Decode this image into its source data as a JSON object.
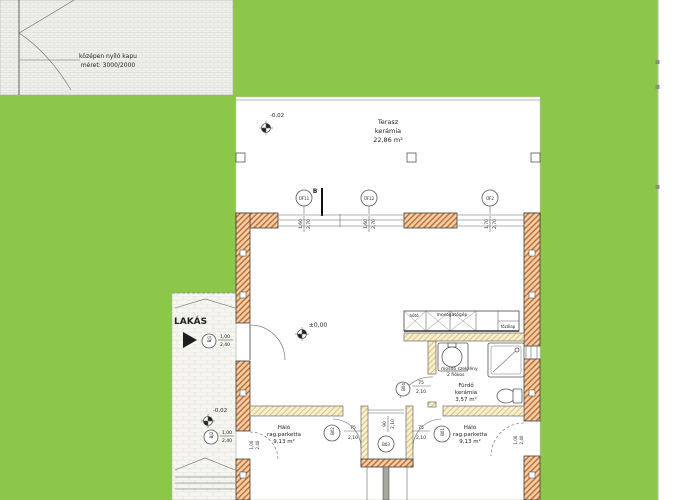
{
  "site": {
    "gate": {
      "line1": "középen nyíló kapu",
      "line2": "méret: 3000/2000"
    },
    "walkway": {
      "label": "LAKÁS",
      "level": "-0,02",
      "door1": {
        "id": "BJ1",
        "w": "1,00",
        "h": "2,40"
      },
      "door2": {
        "id": "BJ2",
        "w": "1,00",
        "h": "2,40"
      }
    }
  },
  "terrace": {
    "name": "Terasz",
    "finish": "kerámia",
    "area": "22,86 m²",
    "level": "-0,02",
    "section": "B",
    "windows": [
      {
        "id": "ÜF11",
        "w": "1,60",
        "h": "2,70"
      },
      {
        "id": "ÜF12",
        "w": "1,60",
        "h": "2,70"
      },
      {
        "id": "ÜF2",
        "w": "1,70",
        "h": "2,70"
      }
    ]
  },
  "living": {
    "level": "±0,00",
    "kitchen": {
      "fridge": "hűtő",
      "dishwasher": "mosogatógép",
      "cooktop": "főzőlap"
    }
  },
  "bathroom": {
    "name": "Fürdő",
    "finish": "kerámia",
    "area": "3,57 m²",
    "vanity1": "mosdó szekrény",
    "vanity2": "2 fiókos",
    "door": {
      "id": "B04",
      "w": "75",
      "h": "2,10"
    }
  },
  "bedrooms": {
    "left": {
      "name": "Háló",
      "finish": "rag.parketta",
      "area": "9,13 m²",
      "door": {
        "id": "B02",
        "w": "75",
        "h": "2,10"
      },
      "window": {
        "w": "1,00",
        "h": "2,40"
      }
    },
    "right": {
      "name": "Háló",
      "finish": "rag.parketta",
      "area": "9,13 m²",
      "door": {
        "id": "B01",
        "w": "75",
        "h": "2,10"
      },
      "window": {
        "w": "1,00",
        "h": "2,40"
      }
    }
  },
  "hall": {
    "door": {
      "id": "B03",
      "w": "90",
      "h": "2,10"
    }
  },
  "colors": {
    "grass": "#8CC74A",
    "wall_line": "#C06A32",
    "wall_bg": "#F2CFA6",
    "partition_line": "#D9C27E",
    "partition_bg": "#F7EFD0"
  }
}
